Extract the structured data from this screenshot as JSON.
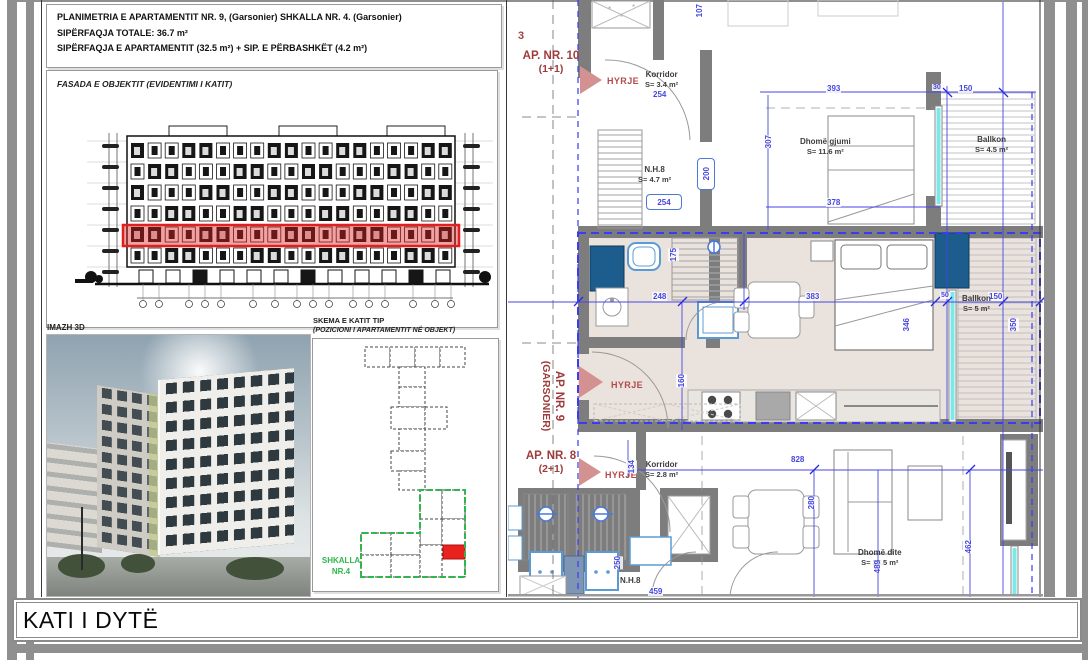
{
  "header": {
    "line1": "PLANIMETRIA E APARTAMENTIT NR. 9, (Garsonier) SHKALLA NR. 4. (Garsonier)",
    "line2": "SIPËRFAQJA TOTALE: 36.7 m²",
    "line3": "SIPËRFAQJA E APARTAMENTIT (32.5 m²) + SIP. E PËRBASHKËT (4.2 m²)"
  },
  "facade": {
    "label": "FASADA E OBJEKTIT (EVIDENTIMI I KATIT)",
    "floors": 6,
    "columns": 19,
    "highlight_row": 4,
    "highlight_color": "#e02020"
  },
  "image3d": {
    "label": "IMAZH 3D"
  },
  "skema": {
    "title": "SKEMA E KATIT TIP",
    "subtitle": "(POZICIONI I APARTAMENTIT NË OBJEKT)",
    "stair_label": "SHKALLA",
    "stair_number": "NR.4",
    "stair_color": "#2eb84b",
    "highlight_color": "#e8231d"
  },
  "plan": {
    "grid_label": "3",
    "ap10_label": "AP. NR. 10",
    "ap10_type": "(1+1)",
    "ap9_label": "AP. NR. 9",
    "ap9_type": "(GARSONIER)",
    "ap8_label": "AP. NR. 8",
    "ap8_type": "(2+1)",
    "hyrje": "HYRJE",
    "rooms": {
      "korridor10": {
        "name": "Korridor",
        "area": "S= 3.4 m²"
      },
      "nh8_top": {
        "name": "N.H.8",
        "area": "S= 4.7 m²"
      },
      "dhome_gjumi": {
        "name": "Dhomë gjumi",
        "area": "S= 11.6 m²"
      },
      "ballkon10": {
        "name": "Ballkon",
        "area": "S= 4.5 m²"
      },
      "ballkon9": {
        "name": "Ballkon",
        "area": "S= 5 m²"
      },
      "korridor8": {
        "name": "Korridor",
        "area": "S= 2.8 m²"
      },
      "dhome_dite": {
        "name": "Dhomë dite",
        "area": "S= 25.5 m²"
      },
      "nh8_bottom": {
        "name": "N.H.8",
        "area": ""
      }
    },
    "dims": {
      "d254a": "254",
      "d107": "107",
      "d393": "393",
      "d30": "30",
      "d150a": "150",
      "d307": "307",
      "d200": "200",
      "d254b": "254",
      "d378": "378",
      "d175": "175",
      "d248": "248",
      "d383": "383",
      "d50": "50",
      "d150b": "150",
      "d346": "346",
      "d350": "350",
      "d160": "160",
      "d134": "134",
      "d828": "828",
      "d280": "280",
      "d250": "250",
      "d489": "489",
      "d462": "462",
      "d459": "459"
    }
  },
  "title_block": {
    "text": "KATI I DYTË"
  },
  "colors": {
    "dim_blue": "#4646e0",
    "apartment_red": "#9e3b3b",
    "wall_gray": "#7d7d7d",
    "highlight_dashed_blue": "#3b3bf0",
    "shaft_blue": "#1c5d8d",
    "window_cyan": "#7de8e8"
  }
}
